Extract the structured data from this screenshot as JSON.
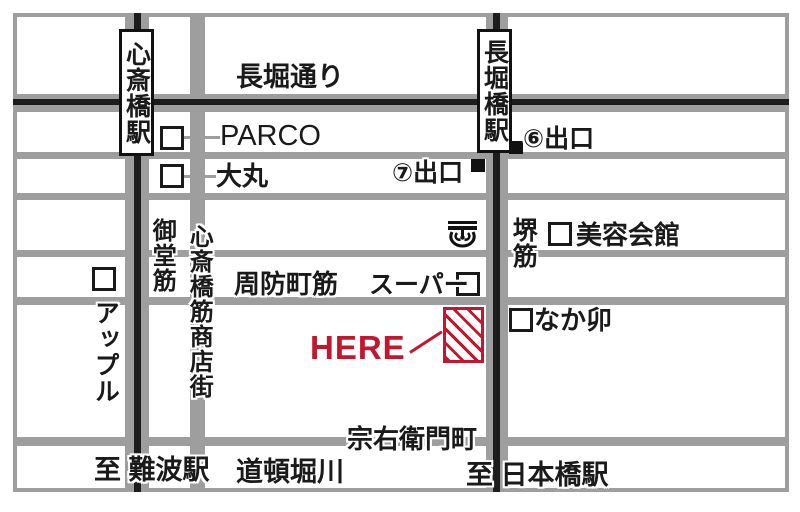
{
  "map": {
    "stations": {
      "shinsaibashi": "心斎橋駅",
      "nagahoribashi": "長堀橋駅"
    },
    "streets": {
      "nagahori_dori": "長堀通り",
      "midosuji": "御堂筋",
      "shinsaibashi_suji_shotengai": "心斎橋筋商店街",
      "sakai_suji": "堺筋",
      "suomachi_suji": "周防町筋",
      "soemoncho": "宗右衛門町",
      "dotonbori_gawa": "道頓堀川"
    },
    "landmarks": {
      "parco": "PARCO",
      "daimaru": "大丸",
      "apple": "アップル",
      "supermarket": "スーパー",
      "biyo_kaikan": "美容会館",
      "nakau": "なか卯"
    },
    "exits": {
      "exit6": "⑥出口",
      "exit7": "⑦出口"
    },
    "directions": {
      "to_namba": "至 難波駅",
      "to_nipponbashi": "至 日本橋駅"
    },
    "here_label": "HERE",
    "colors": {
      "accent_red": "#c2182f",
      "road_grey": "#9e9e9e",
      "subway_line_black": "#1c1c1c"
    },
    "icons": {
      "metro": "osaka-metro-icon"
    }
  }
}
